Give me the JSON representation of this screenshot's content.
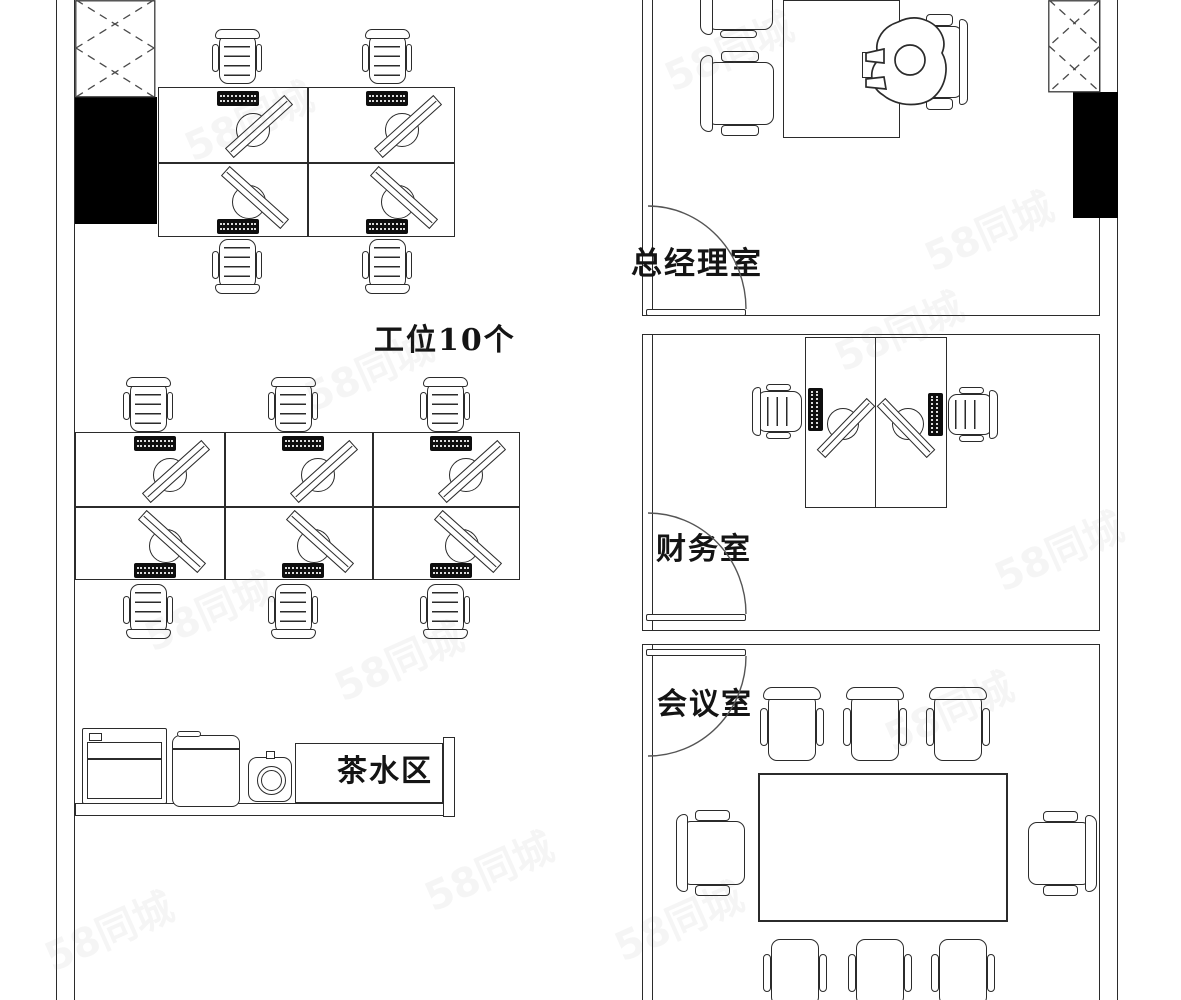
{
  "document": {
    "kind": "office floor plan drawing",
    "background": "#ffffff",
    "line_color": "#2b2b2b",
    "wall_fill": "#000000"
  },
  "labels": {
    "workstations_area": "工位10个",
    "gm_office": "总经理室",
    "finance_room": "财务室",
    "meeting_room": "会议室",
    "tea_area": "茶水区"
  },
  "watermark": {
    "text": "58同城"
  },
  "inventory": {
    "open_office_workstations": 10,
    "gm_office_guest_chairs": 2,
    "finance_desks": 2,
    "meeting_table_chairs": 8,
    "tea_area_appliances": 3
  }
}
